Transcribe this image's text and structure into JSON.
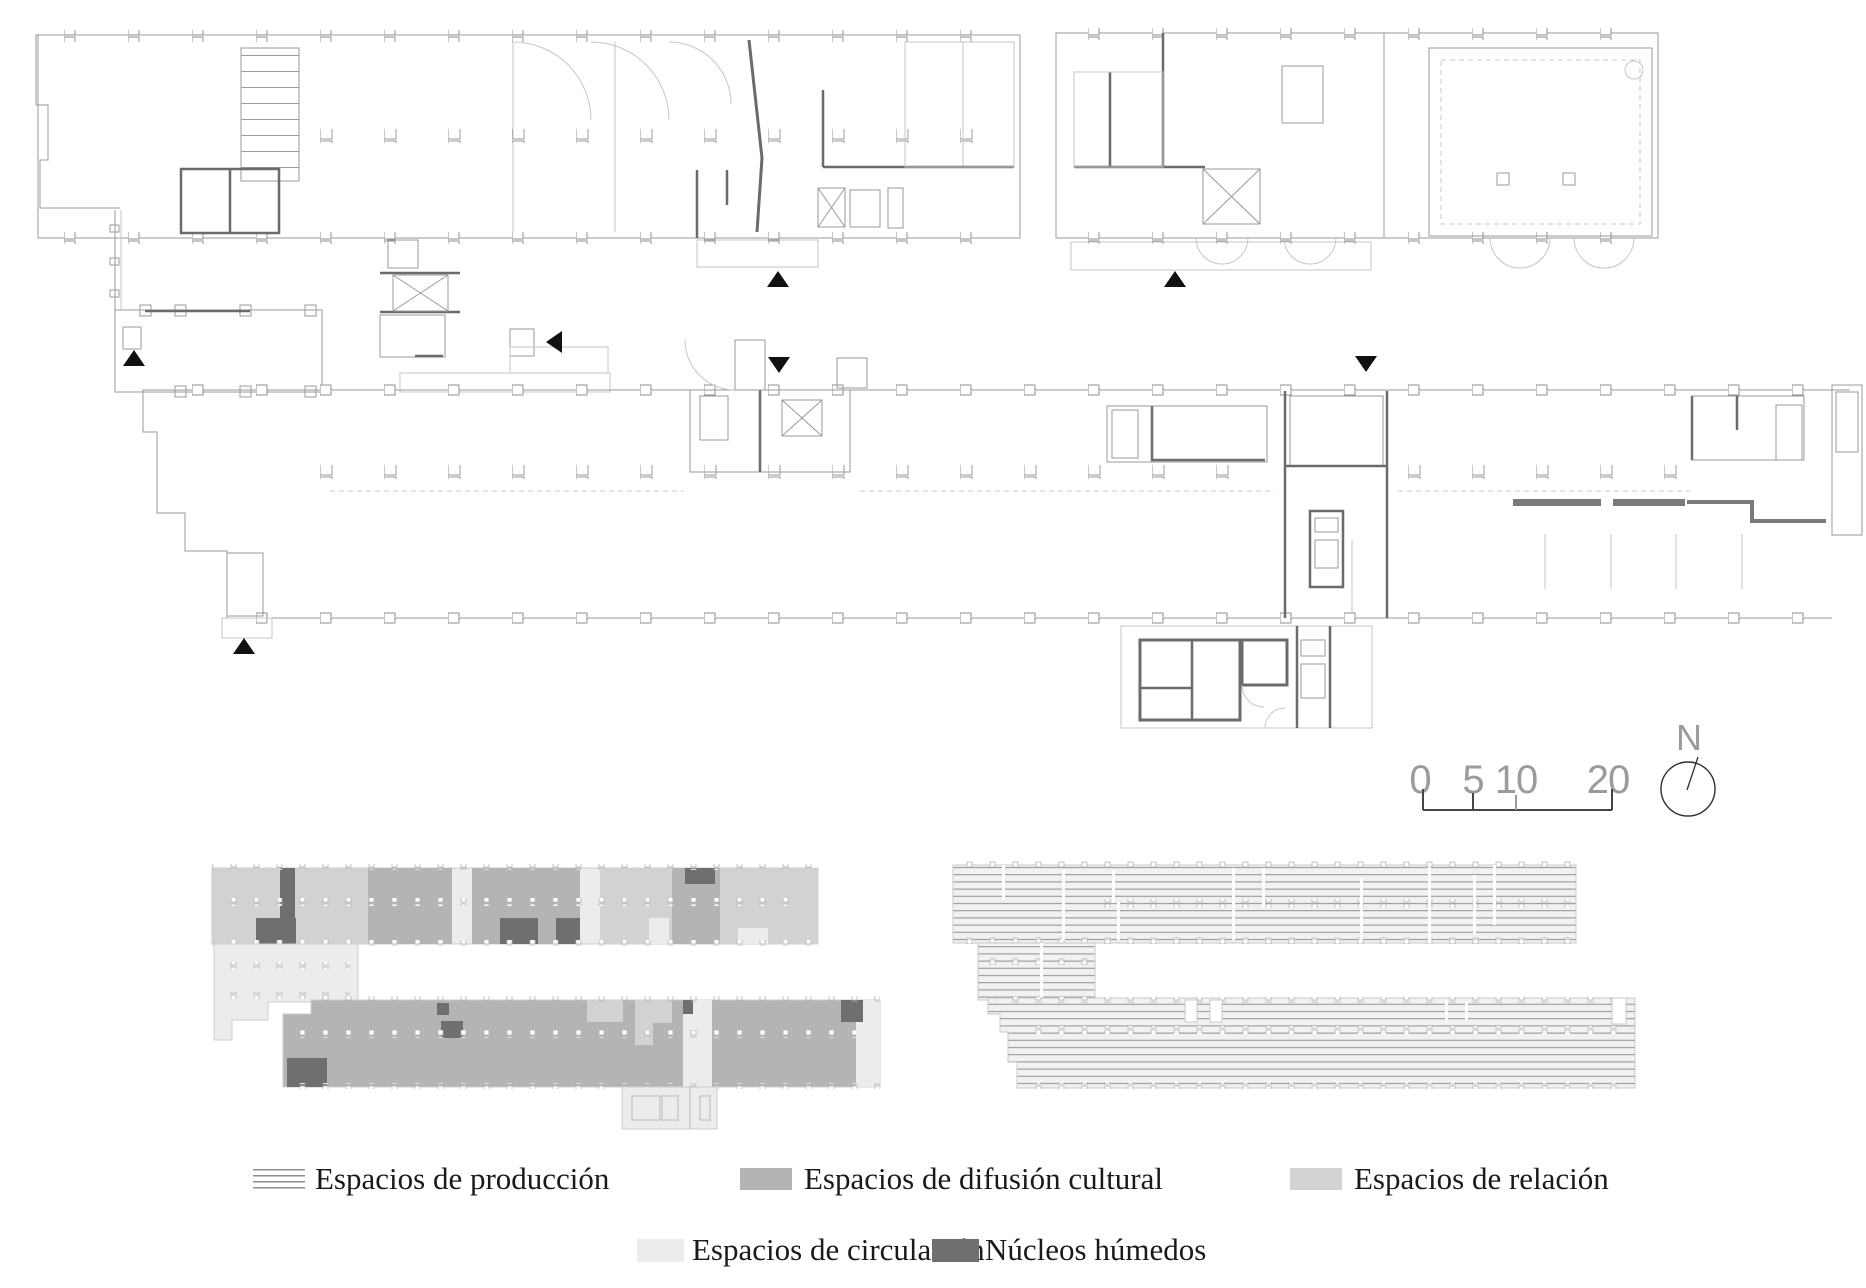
{
  "sheet": {
    "type": "architectural floor plan drawing",
    "background": "#ffffff"
  },
  "legend": {
    "items": [
      {
        "id": "produccion",
        "label": "Espacios de producción",
        "swatch": "hatch-lines"
      },
      {
        "id": "difusion",
        "label": "Espacios de difusión cultural",
        "swatch": "#b4b4b4"
      },
      {
        "id": "relacion",
        "label": "Espacios de relación",
        "swatch": "#d2d2d2"
      },
      {
        "id": "circulacion",
        "label": "Espacios de circulación",
        "swatch": "#ececec"
      },
      {
        "id": "nucleos",
        "label": "Núcleos húmedos",
        "swatch": "#6f6f6f"
      }
    ]
  },
  "scale_bar": {
    "labels": [
      "0",
      "5",
      "10",
      "20"
    ]
  },
  "compass": {
    "label": "N"
  },
  "colors": {
    "produccion_hatch_line": "#8f8f8f",
    "difusion": "#b4b4b4",
    "relacion": "#d2d2d2",
    "circulacion": "#ececec",
    "nucleos": "#6f6f6f",
    "plan_line_light": "#9a9a9a",
    "plan_line_dark": "#6b6b6b",
    "marker": "#111111",
    "scale_text": "#9b9b9b",
    "legend_text": "#1a1a1a"
  },
  "markers": [
    {
      "dir": "up",
      "x": 778,
      "y": 281
    },
    {
      "dir": "up",
      "x": 1175,
      "y": 281
    },
    {
      "dir": "up",
      "x": 134,
      "y": 360
    },
    {
      "dir": "up",
      "x": 244,
      "y": 648
    },
    {
      "dir": "left",
      "x": 553,
      "y": 342
    },
    {
      "dir": "down",
      "x": 779,
      "y": 366
    },
    {
      "dir": "down",
      "x": 1366,
      "y": 365
    }
  ]
}
